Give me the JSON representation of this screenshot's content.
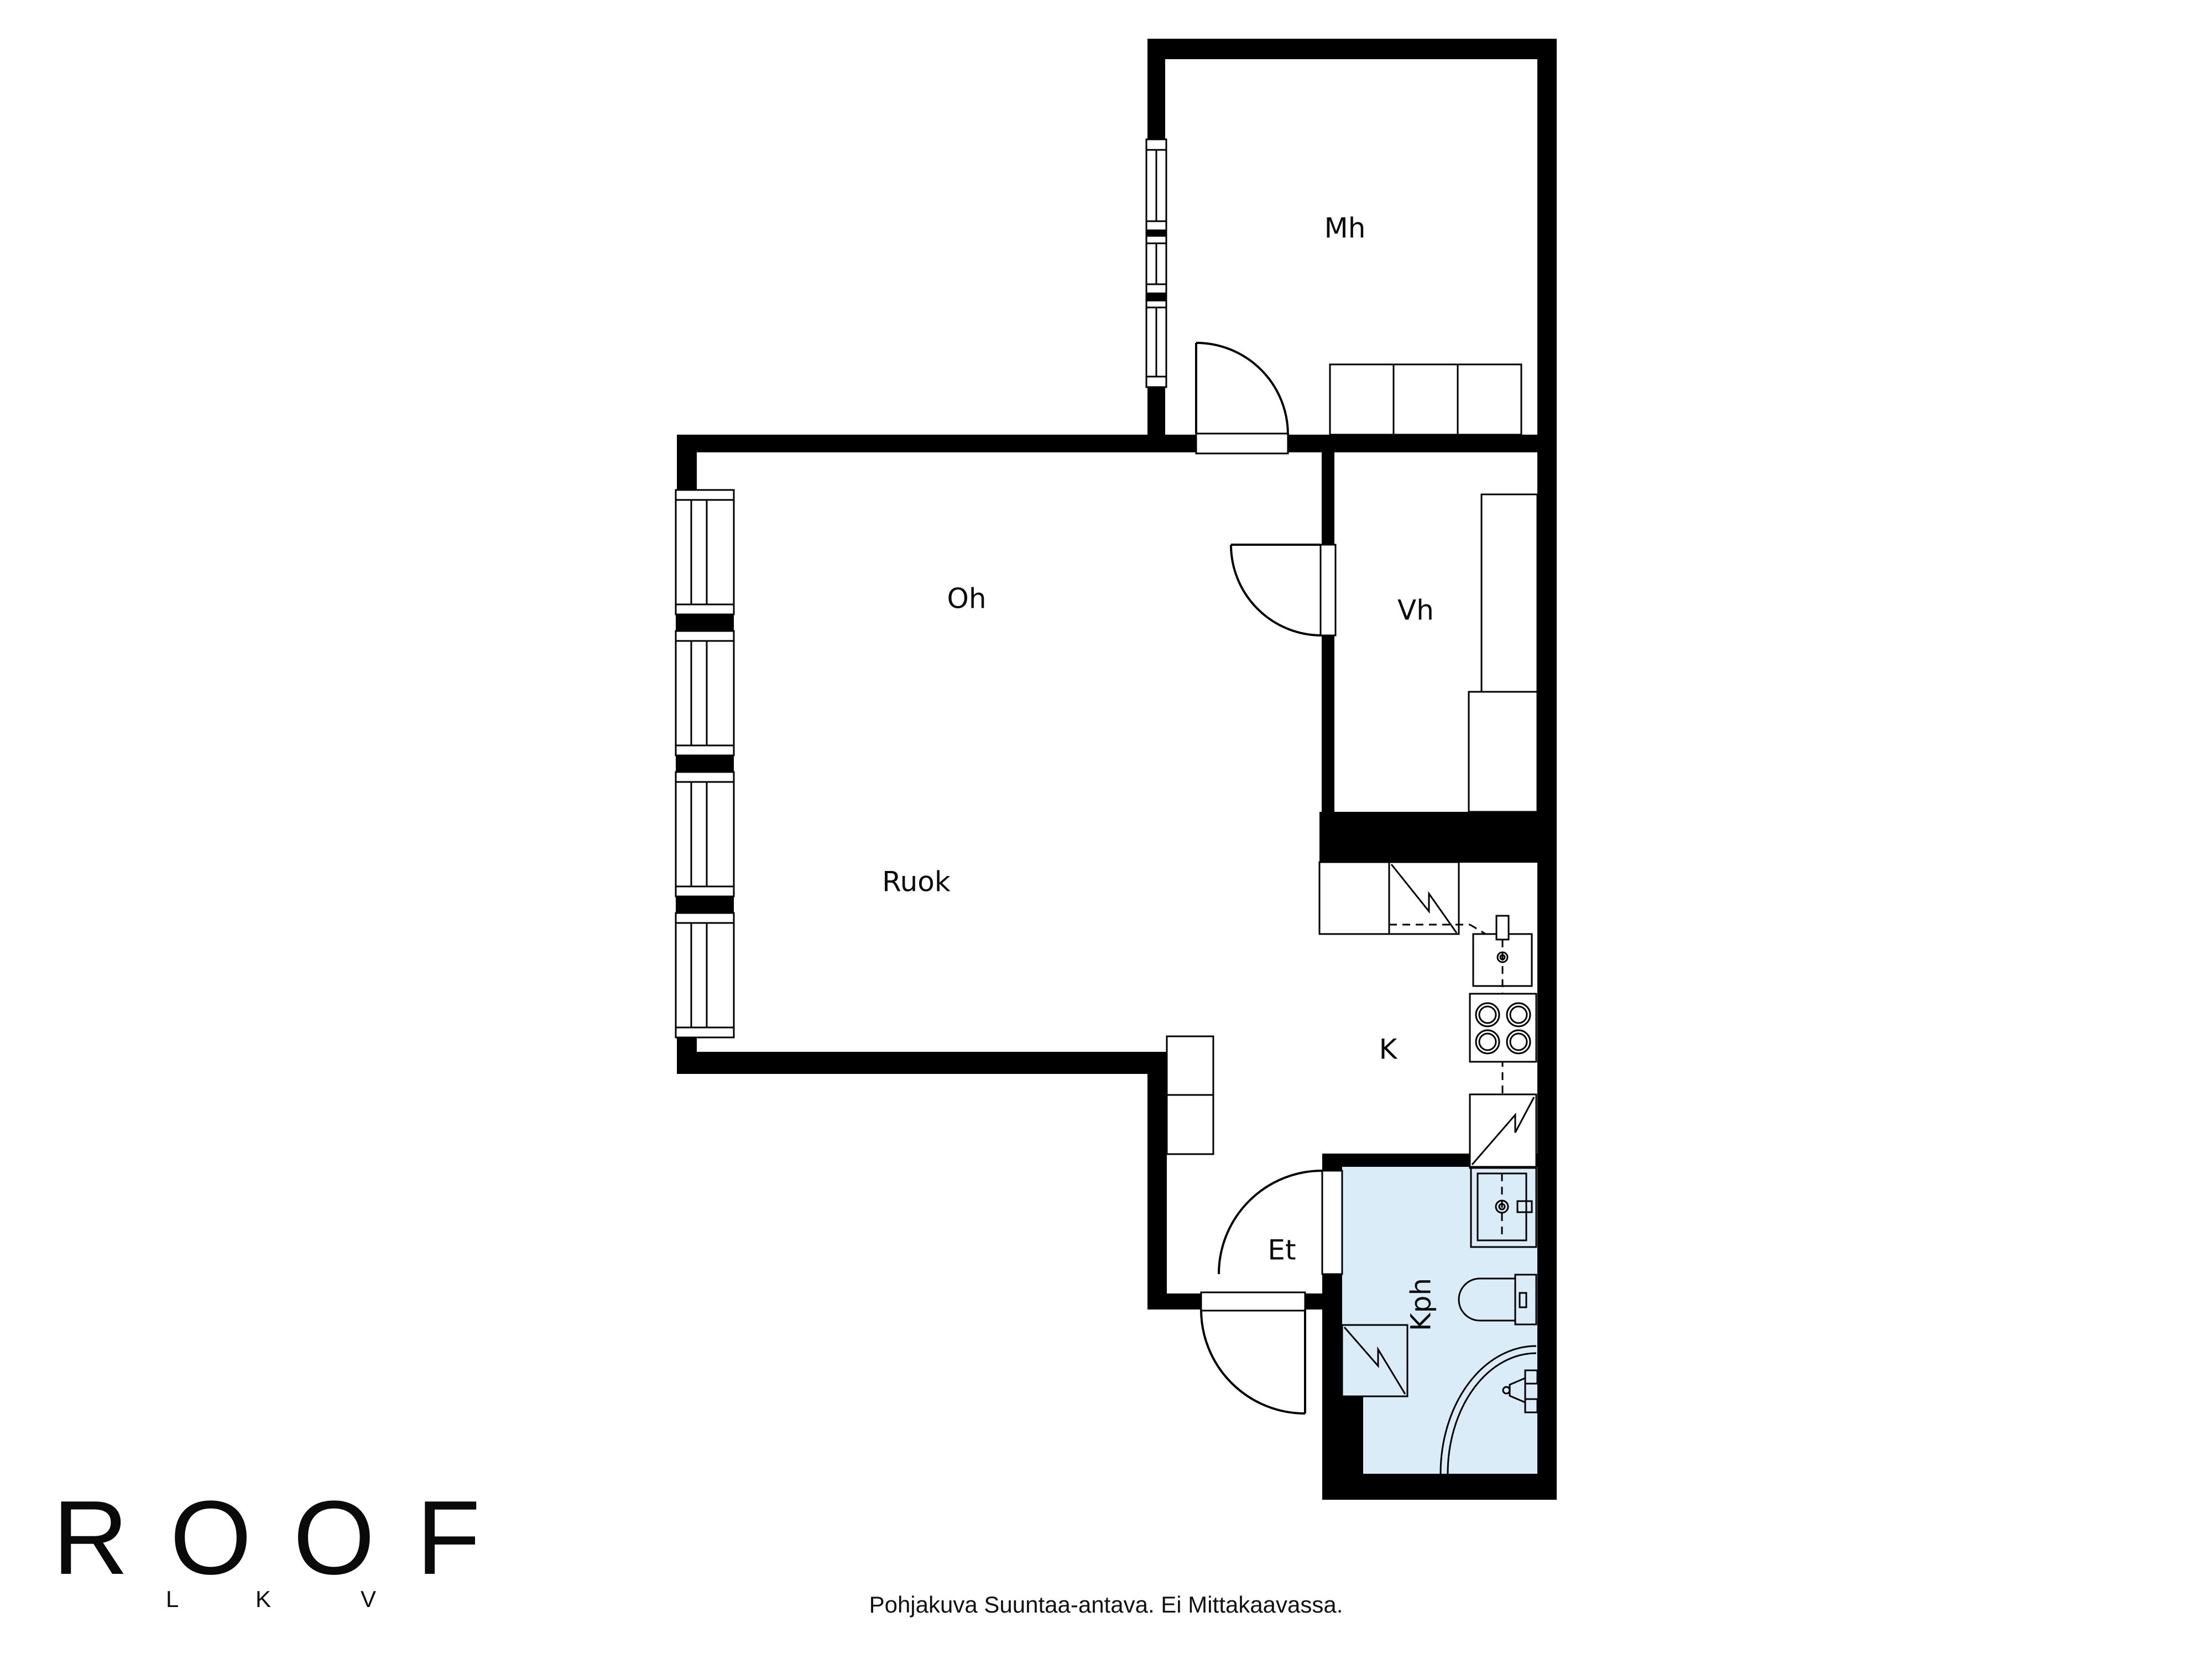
{
  "rooms": {
    "bedroom": {
      "label": "Mh"
    },
    "living": {
      "label": "Oh"
    },
    "dining": {
      "label": "Ruok"
    },
    "closet": {
      "label": "Vh"
    },
    "kitchen": {
      "label": "K"
    },
    "entry": {
      "label": "Et"
    },
    "bathroom": {
      "label": "Kph"
    }
  },
  "logo": {
    "brand": "ROOF",
    "letters": [
      "L",
      "K",
      "V"
    ]
  },
  "footer": {
    "disclaimer": "Pohjakuva Suuntaa-antava. Ei Mittakaavassa."
  },
  "colors": {
    "wall": "#000000",
    "bathroom_fill": "#d9ecf8"
  }
}
